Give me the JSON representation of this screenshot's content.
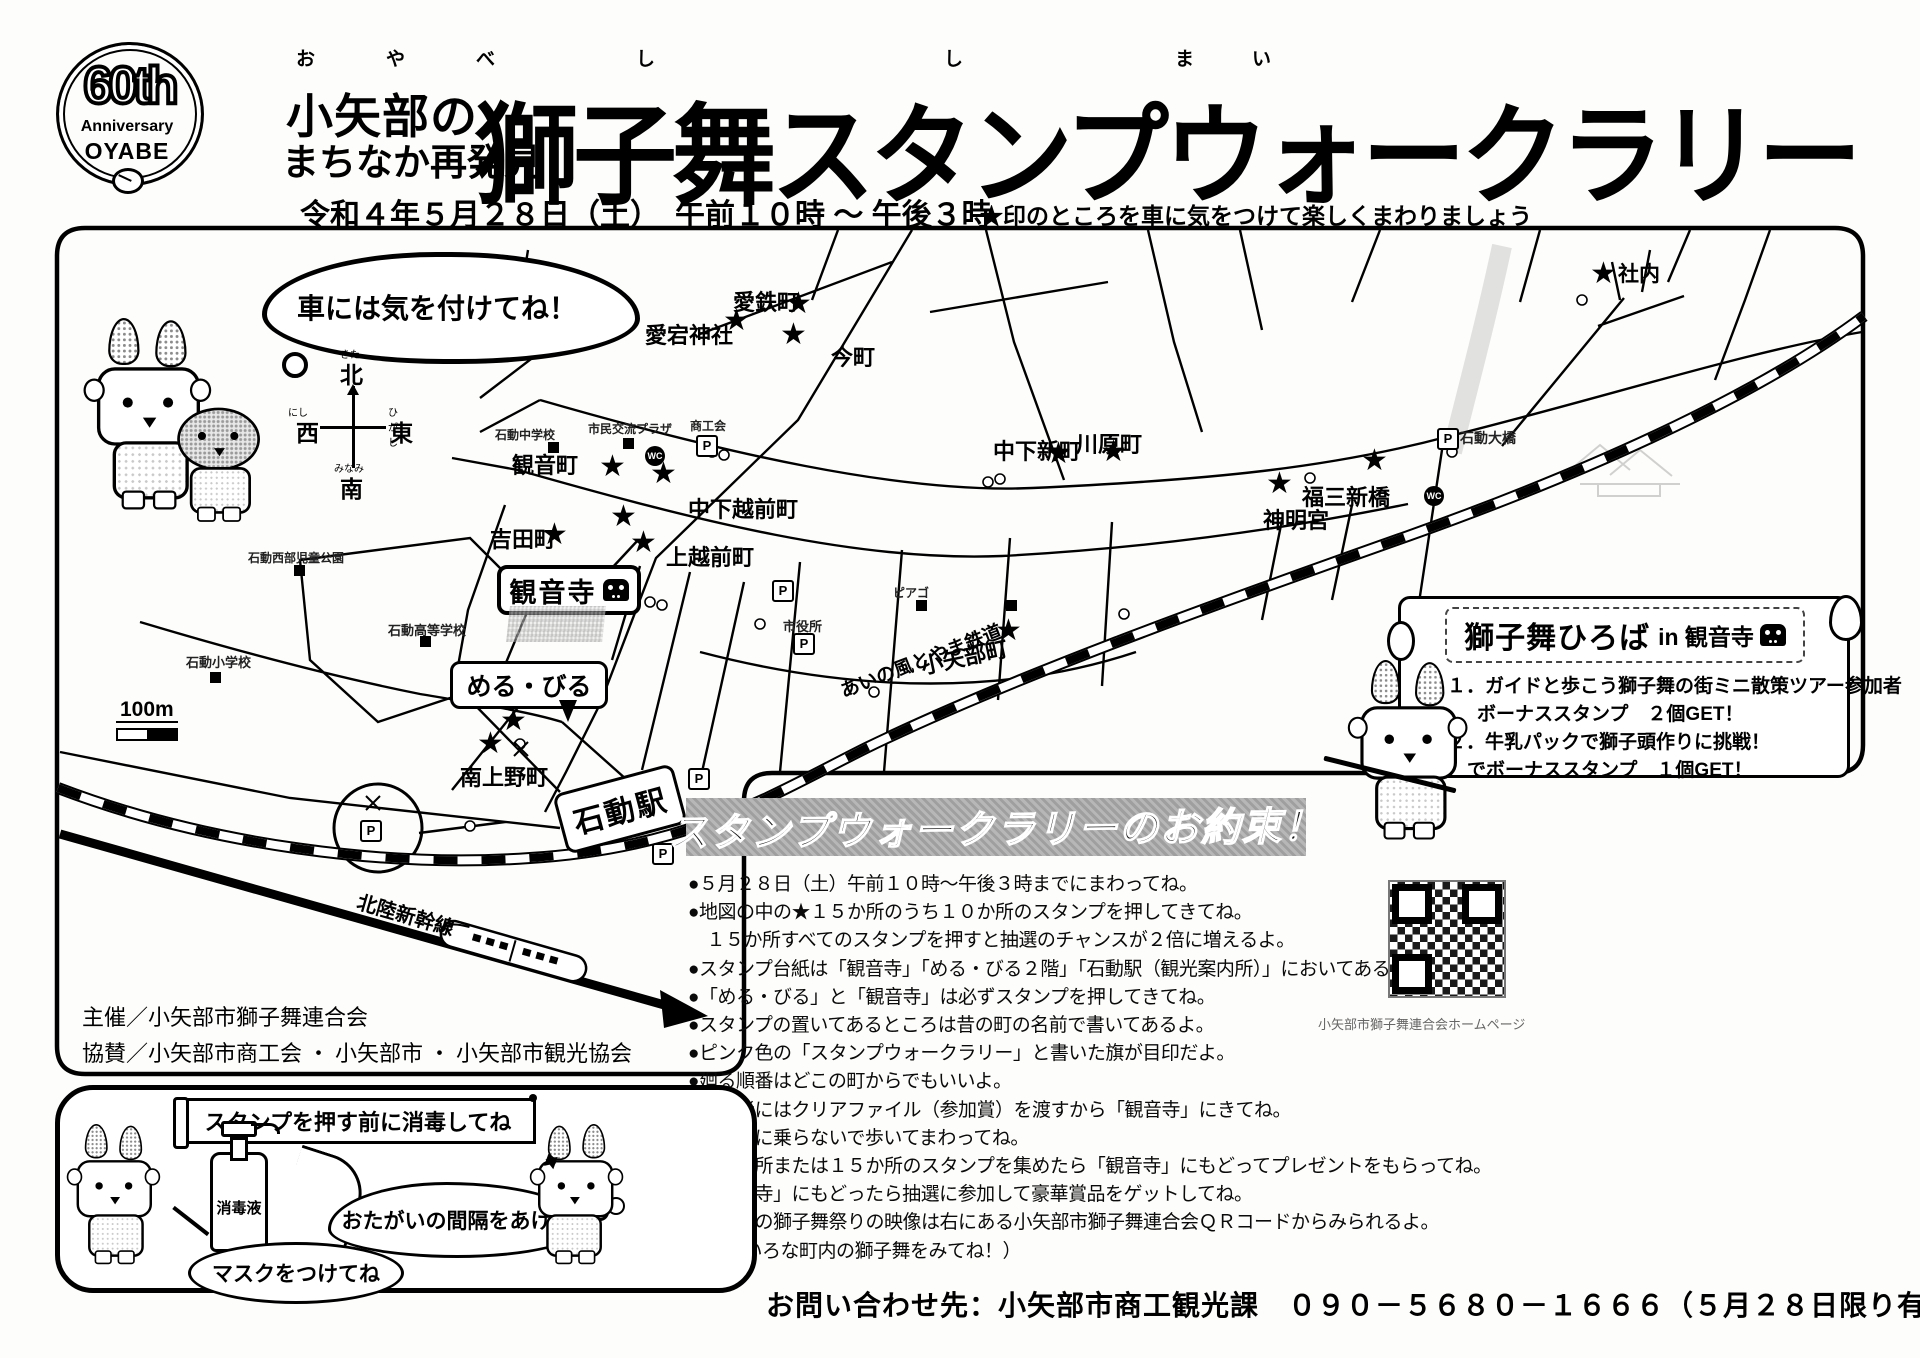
{
  "header": {
    "logo": {
      "top": "60th",
      "mid": "Anniversary",
      "bottom": "OYABE"
    },
    "furigana_left": "お　や　べ",
    "furigana_right": "し　　　し　　まい",
    "title_small_1": "小矢部の",
    "title_small_2": "まちなか再発見",
    "title_main": "獅子舞スタンプウォークラリー",
    "date_line": "令和４年５月２８日（土）　午前１０時 ～ 午後３時",
    "note": "★印のところを車に気をつけて楽しくまわりましょう"
  },
  "map": {
    "bubble": "車には気を付けてね！",
    "compass": {
      "n": "北",
      "s": "南",
      "e": "東",
      "w": "西",
      "kn": "きた",
      "ks": "みなみ",
      "ke": "ひがし",
      "kw": "にし"
    },
    "scale_label": "100m",
    "railway_label": "あいの風とやま鉄道",
    "shinkansen_label": "北陸新幹線",
    "kannonji_box": "観音寺",
    "merubiru_box": "める・びる",
    "station_box": "石動駅",
    "icons": {
      "parking": "P",
      "restroom": "WC",
      "star": "★"
    },
    "labels": [
      {
        "t": "愛鉄町",
        "x": 733,
        "y": 285,
        "fs": 22
      },
      {
        "t": "愛宕神社",
        "x": 645,
        "y": 318,
        "fs": 22
      },
      {
        "t": "今町",
        "x": 831,
        "y": 340,
        "fs": 22
      },
      {
        "t": "観音町",
        "x": 512,
        "y": 448,
        "fs": 22
      },
      {
        "t": "中下越前町",
        "x": 688,
        "y": 492,
        "fs": 22
      },
      {
        "t": "吉田町",
        "x": 490,
        "y": 522,
        "fs": 22
      },
      {
        "t": "上越前町",
        "x": 666,
        "y": 540,
        "fs": 22
      },
      {
        "t": "中下新町",
        "x": 993,
        "y": 434,
        "fs": 22
      },
      {
        "t": "川原町",
        "x": 1076,
        "y": 427,
        "fs": 22
      },
      {
        "t": "福三新橋",
        "x": 1302,
        "y": 480,
        "fs": 22
      },
      {
        "t": "神明宮",
        "x": 1263,
        "y": 503,
        "fs": 22
      },
      {
        "t": "社内",
        "x": 1618,
        "y": 258,
        "fs": 21
      },
      {
        "t": "小矢部町",
        "x": 920,
        "y": 640,
        "fs": 22,
        "rot": -12
      },
      {
        "t": "南上野町",
        "x": 460,
        "y": 760,
        "fs": 22
      }
    ],
    "stars": [
      [
        800,
        305
      ],
      [
        738,
        322
      ],
      [
        795,
        336
      ],
      [
        614,
        468
      ],
      [
        665,
        475
      ],
      [
        556,
        536
      ],
      [
        645,
        544
      ],
      [
        625,
        518
      ],
      [
        1060,
        455
      ],
      [
        1115,
        453
      ],
      [
        1376,
        462
      ],
      [
        1281,
        485
      ],
      [
        1605,
        275
      ],
      [
        1010,
        632
      ],
      [
        492,
        745
      ],
      [
        515,
        722
      ]
    ],
    "poi": [
      {
        "t": "石動中学校",
        "x": 495,
        "y": 426,
        "fs": 12
      },
      {
        "t": "市民交流プラザ",
        "x": 588,
        "y": 420,
        "fs": 12
      },
      {
        "t": "商工会",
        "x": 690,
        "y": 417,
        "fs": 12
      },
      {
        "t": "市役所",
        "x": 783,
        "y": 616,
        "fs": 13
      },
      {
        "t": "石動高等学校",
        "x": 388,
        "y": 620,
        "fs": 13
      },
      {
        "t": "石動小学校",
        "x": 186,
        "y": 652,
        "fs": 13
      },
      {
        "t": "石動西部児童公園",
        "x": 248,
        "y": 549,
        "fs": 12
      },
      {
        "t": "石動大橋",
        "x": 1460,
        "y": 428,
        "fs": 14
      },
      {
        "t": "ピアゴ",
        "x": 893,
        "y": 584,
        "fs": 12
      }
    ],
    "squares": [
      [
        548,
        442
      ],
      [
        623,
        438
      ],
      [
        420,
        636
      ],
      [
        210,
        672
      ],
      [
        294,
        565
      ],
      [
        916,
        600
      ],
      [
        1006,
        600
      ]
    ],
    "pmarks": [
      [
        696,
        435
      ],
      [
        772,
        580
      ],
      [
        793,
        633
      ],
      [
        360,
        820
      ],
      [
        688,
        768
      ],
      [
        652,
        843
      ],
      [
        1437,
        428
      ]
    ],
    "wc": [
      [
        645,
        446
      ],
      [
        1424,
        486
      ]
    ]
  },
  "hiroba": {
    "title_bold": "獅子舞ひろば",
    "title_rest": "in 観音寺",
    "items": [
      "１．ガイドと歩こう獅子舞の街ミニ散策ツアー参加者",
      "ボーナススタンプ　２個GET！",
      "２．牛乳パックで獅子頭作りに挑戦！",
      "でボーナススタンプ　１個GET！"
    ]
  },
  "rules": {
    "title": "スタンプウォークラリーのお約束！",
    "bullets": [
      "●５月２８日（土）午前１０時～午後３時までにまわってね。",
      "●地図の中の★１５か所のうち１０か所のスタンプを押してきてね。",
      "　１５か所すべてのスタンプを押すと抽選のチャンスが２倍に増えるよ。",
      "●スタンプ台紙は「観音寺」「める・びる２階」「石動駅（観光案内所）」においてあるよ。",
      "●「める・びる」と「観音寺」は必ずスタンプを押してきてね。",
      "●スタンプの置いてあるところは昔の町の名前で書いてあるよ。",
      "●ピンク色の「スタンプウォークラリー」と書いた旗が目印だよ。",
      "●廻る順番はどこの町からでもいいよ。",
      "●参加者にはクリアファイル（参加賞）を渡すから「観音寺」にきてね。",
      "●乗り物に乗らないで歩いてまわってね。",
      "●１０か所または１５か所のスタンプを集めたら「観音寺」にもどってプレゼントをもらってね。",
      "●「観音寺」にもどったら抽選に参加して豪華賞品をゲットしてね。",
      "●小矢部の獅子舞祭りの映像は右にある小矢部市獅子舞連合会ＱＲコードからみられるよ。",
      "（いろいろな町内の獅子舞をみてね！）"
    ]
  },
  "sanitize": {
    "banner": "スタンプを押す前に消毒してね",
    "bottle": "消毒液",
    "bubble_mask": "マスクをつけてね",
    "bubble_distance": "おたがいの間隔をあけて"
  },
  "credits": {
    "organizer": "主催／小矢部市獅子舞連合会",
    "sponsor": "協賛／小矢部市商工会 ・ 小矢部市 ・ 小矢部市観光協会"
  },
  "qr_caption": "小矢部市獅子舞連合会ホームページ",
  "contact": "お問い合わせ先：小矢部市商工観光課　０９０－５６８０－１６６６（５月２８日限り有効）"
}
